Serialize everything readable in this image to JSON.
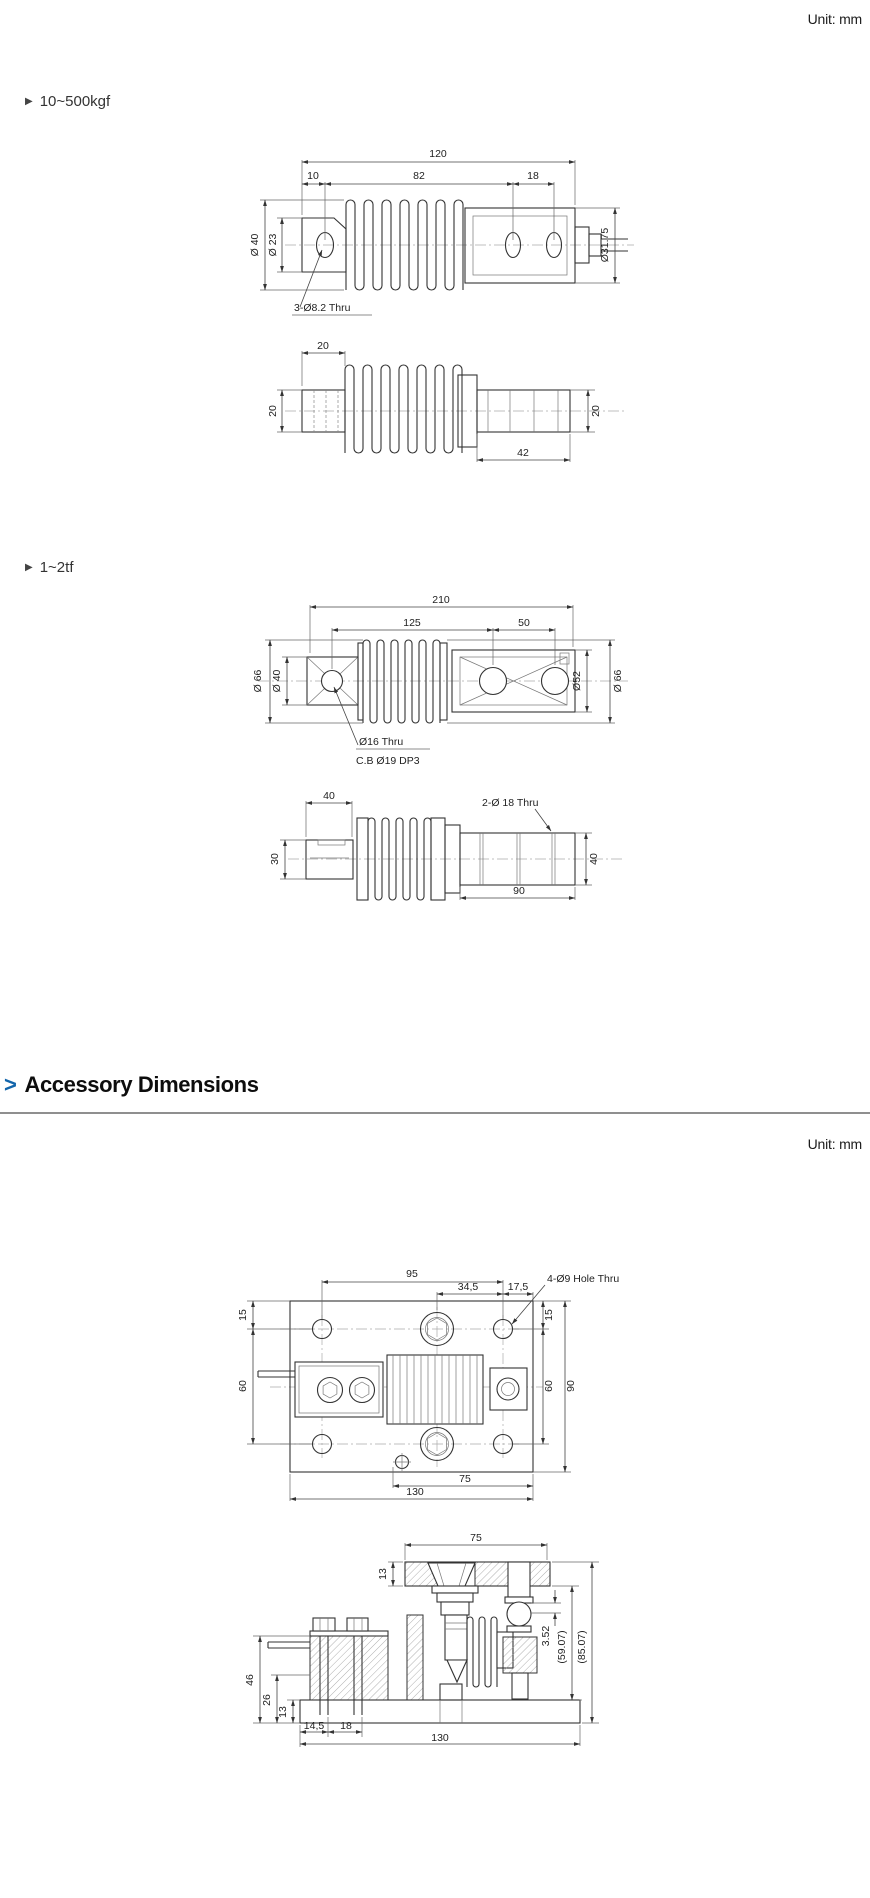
{
  "page": {
    "unit_top": "Unit: mm",
    "unit_bottom": "Unit: mm"
  },
  "sections": {
    "range1": {
      "marker": "▶",
      "label": "10~500kgf"
    },
    "range2": {
      "marker": "▶",
      "label": "1~2tf"
    }
  },
  "accessory_heading": {
    "marker": ">",
    "text": "Accessory Dimensions"
  },
  "colors": {
    "accent_blue": "#1265ab",
    "line": "#333333",
    "rule_gray": "#8f8f8f"
  },
  "drawings": {
    "kgf_side": {
      "dims": {
        "overall": "120",
        "seg1": "10",
        "seg2": "82",
        "seg3": "18",
        "dia_left_outer": "Ø 40",
        "dia_left_inner": "Ø 23",
        "dia_right": "Ø31.75",
        "hole_note": "3-Ø8.2 Thru"
      }
    },
    "kgf_top": {
      "dims": {
        "top": "20",
        "left": "20",
        "right": "20",
        "bottom": "42"
      }
    },
    "tf_side": {
      "dims": {
        "overall": "210",
        "seg1": "125",
        "seg2": "50",
        "dia_left_outer": "Ø 66",
        "dia_left_inner": "Ø 40",
        "dia_right_inner": "Ø52",
        "dia_right_outer": "Ø 66",
        "hole_note_1": "Ø16 Thru",
        "hole_note_2": "C.B Ø19 DP3"
      }
    },
    "tf_top": {
      "dims": {
        "top": "40",
        "hole_note": "2-Ø 18 Thru",
        "left": "30",
        "right": "40",
        "bottom": "90"
      }
    },
    "acc_plan": {
      "dims": {
        "top1": "95",
        "top2": "34,5",
        "top3": "17,5",
        "hole_note": "4-Ø9 Hole Thru",
        "left_top": "15",
        "left_mid": "60",
        "right_top": "15",
        "right_mid": "60",
        "right_overall": "90",
        "bottom1": "75",
        "bottom2": "130"
      }
    },
    "acc_side": {
      "dims": {
        "top": "75",
        "plate_thk": "13",
        "joint_gap": "3.52",
        "height_inner": "(59.07)",
        "height_overall": "(85.07)",
        "left1": "46",
        "left2": "26",
        "left3": "13",
        "bottom1": "14,5",
        "bottom2": "18",
        "bottom3": "130"
      }
    }
  }
}
